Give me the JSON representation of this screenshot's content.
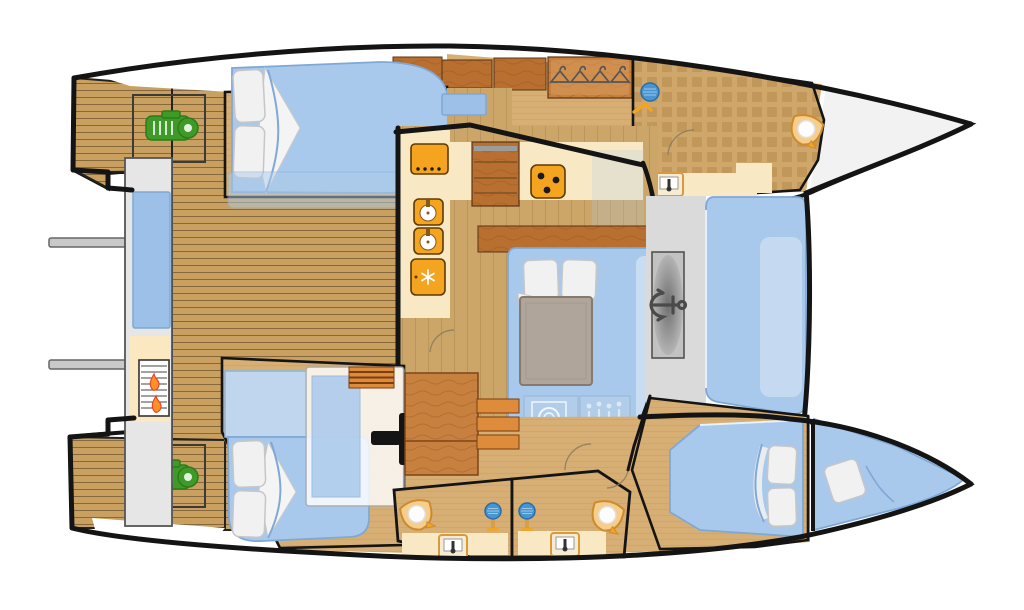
{
  "page": {
    "title": "Catamaran interior deck plan",
    "type": "floor-plan",
    "orientation": "bow-right"
  },
  "palette": {
    "black": "#141414",
    "white": "#FFFFFF",
    "bowFill": "#F2F2F2",
    "teak": "#C9A05F",
    "teakLine": "#6F5730",
    "floor": "#CCA668",
    "floorLine": "#A8854C",
    "tan": "#D7AF74",
    "tanDeep": "#CFA76B",
    "checkerSq": "#C1975A",
    "cream": "#F8E9C4",
    "orange": "#F4A41F",
    "orangeEdge": "#5C3A05",
    "woodMid": "#C8803F",
    "woodDark": "#B96F2F",
    "woodGrain": "#9C5A22",
    "blue": "#A9C9EC",
    "blueDeep": "#7FA8D6",
    "blueLight": "#C8DCF2",
    "blueGlass": "#9DC0E8",
    "overlayBlue": "#B4CFE9",
    "grayPlatform": "#E6E6E6",
    "grayWalk": "#DADADA",
    "grayBox": "#C2C2C2",
    "grayTable": "#AFA59A",
    "green": "#3F9B28",
    "greenDark": "#2F7A1D",
    "flame": "#FF9222",
    "flameEdge": "#E8442A",
    "pillow": "#F1F1F1",
    "pillowEdge": "#C6C6C6",
    "davit": "#C9C9C9",
    "steps": "#DE8B3C",
    "showerBlue": "#4796D2"
  },
  "fixtures": {
    "engines": 2,
    "davits": 2,
    "bbq_grill": 1,
    "cooktops": 2,
    "galley_sinks": 2,
    "fridge": 1,
    "wardrobe_hangers": 4,
    "showers": 3,
    "washbasins": 3,
    "toilets": 3,
    "anchor_windlass": 1,
    "washing_machine": 1,
    "glass_rack": 1,
    "beds": 5,
    "cockpit_table": 1,
    "companionway_steps": 2
  }
}
